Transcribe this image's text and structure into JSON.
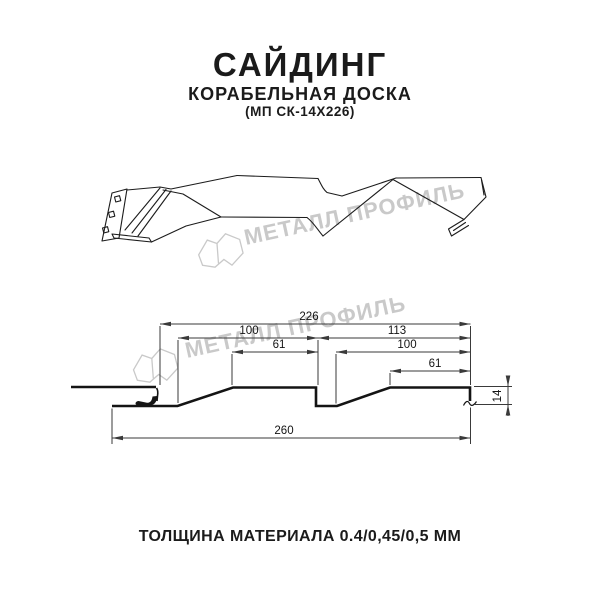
{
  "header": {
    "title": "САЙДИНГ",
    "subtitle": "КОРАБЕЛЬНАЯ ДОСКА",
    "model": "(МП СК-14Х226)"
  },
  "watermark": {
    "brand": "МЕТАЛЛ ПРОФИЛЬ",
    "color": "#c9c9c9"
  },
  "section": {
    "dims": {
      "module_width": "226",
      "left_pitch": "100",
      "right_segment": "113",
      "left_face": "61",
      "right_pitch": "100",
      "right_face": "61",
      "overall_width": "260",
      "profile_height": "14"
    }
  },
  "footer": {
    "text": "ТОЛЩИНА МАТЕРИАЛА 0.4/0,45/0,5 ММ"
  },
  "colors": {
    "line": "#1c1c1c",
    "section_line": "#141414",
    "dim_line": "#3a3a3a",
    "watermark": "#c9c9c9"
  }
}
